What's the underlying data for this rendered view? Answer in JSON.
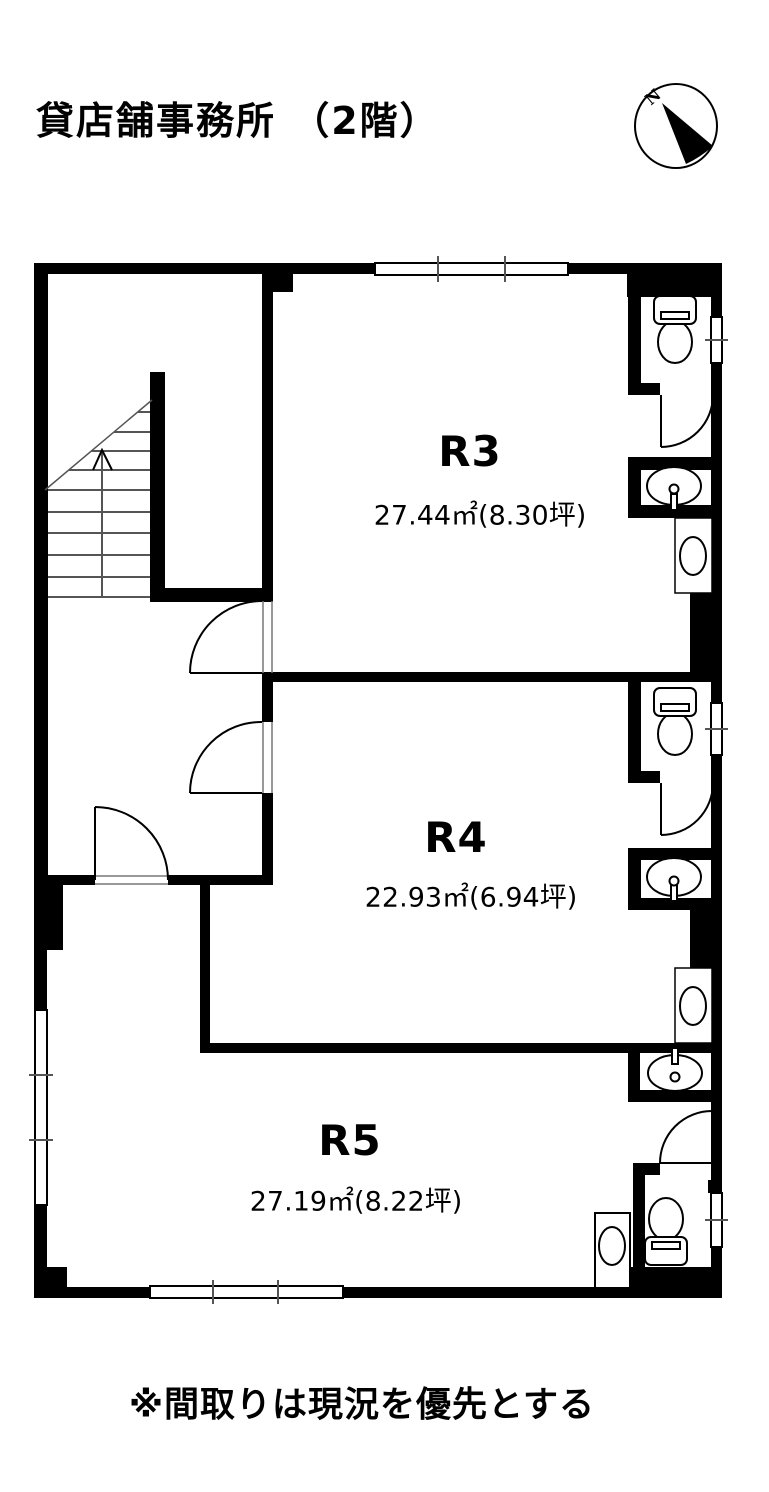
{
  "title": "貸店舗事務所 （2階）",
  "compass": {
    "label": "N"
  },
  "rooms": [
    {
      "name": "R3",
      "area": "27.44㎡(8.30坪)"
    },
    {
      "name": "R4",
      "area": "22.93㎡(6.94坪)"
    },
    {
      "name": "R5",
      "area": "27.19㎡(8.22坪)"
    }
  ],
  "note": "※間取りは現況を優先とする",
  "colors": {
    "wall": "#000000",
    "background": "#ffffff",
    "thin_line": "#555555"
  },
  "icons": [
    "compass-icon",
    "stairs-icon",
    "stairs-up-arrow-icon",
    "toilet-icon",
    "sink-icon",
    "urinal-icon",
    "washing-machine-pan-icon",
    "door-swing-icon",
    "window-icon"
  ]
}
